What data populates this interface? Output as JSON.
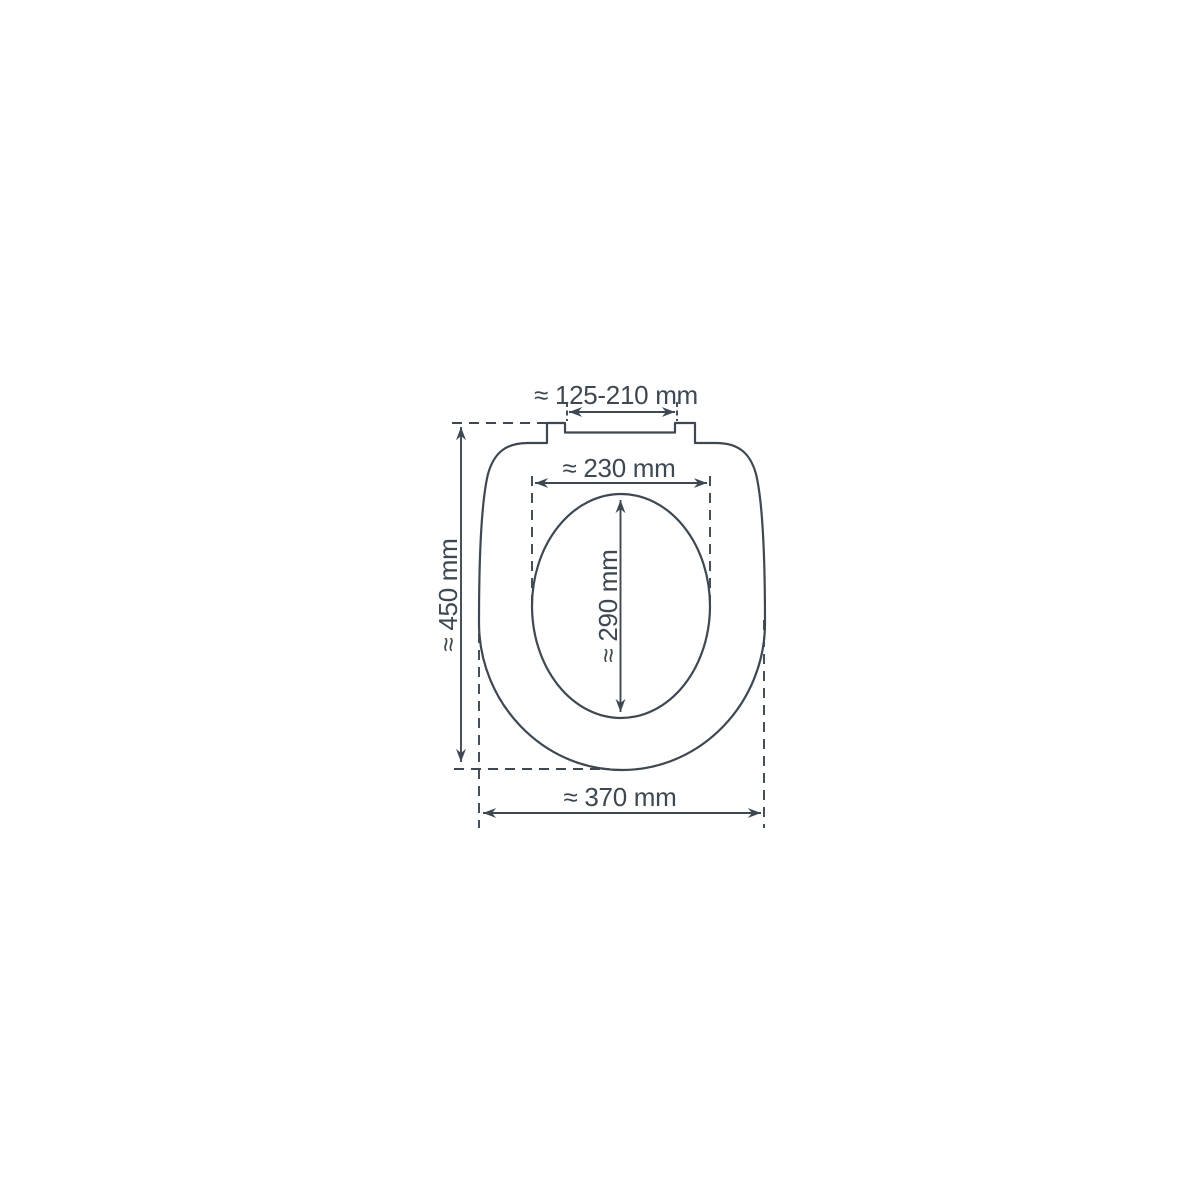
{
  "diagram": {
    "subject": "toilet-seat-dimension-drawing",
    "background_color": "#ffffff",
    "line_color": "#3d4852",
    "labels": {
      "hinge_width": "≈ 125-210 mm",
      "inner_width": "≈ 230 mm",
      "inner_length": "≈ 290 mm",
      "total_length": "≈ 450 mm",
      "total_width": "≈ 370 mm"
    },
    "dimensions_mm": {
      "hinge_width_range": "125-210",
      "inner_opening_width": 230,
      "inner_opening_length": 290,
      "total_length": 450,
      "total_width": 370
    }
  }
}
